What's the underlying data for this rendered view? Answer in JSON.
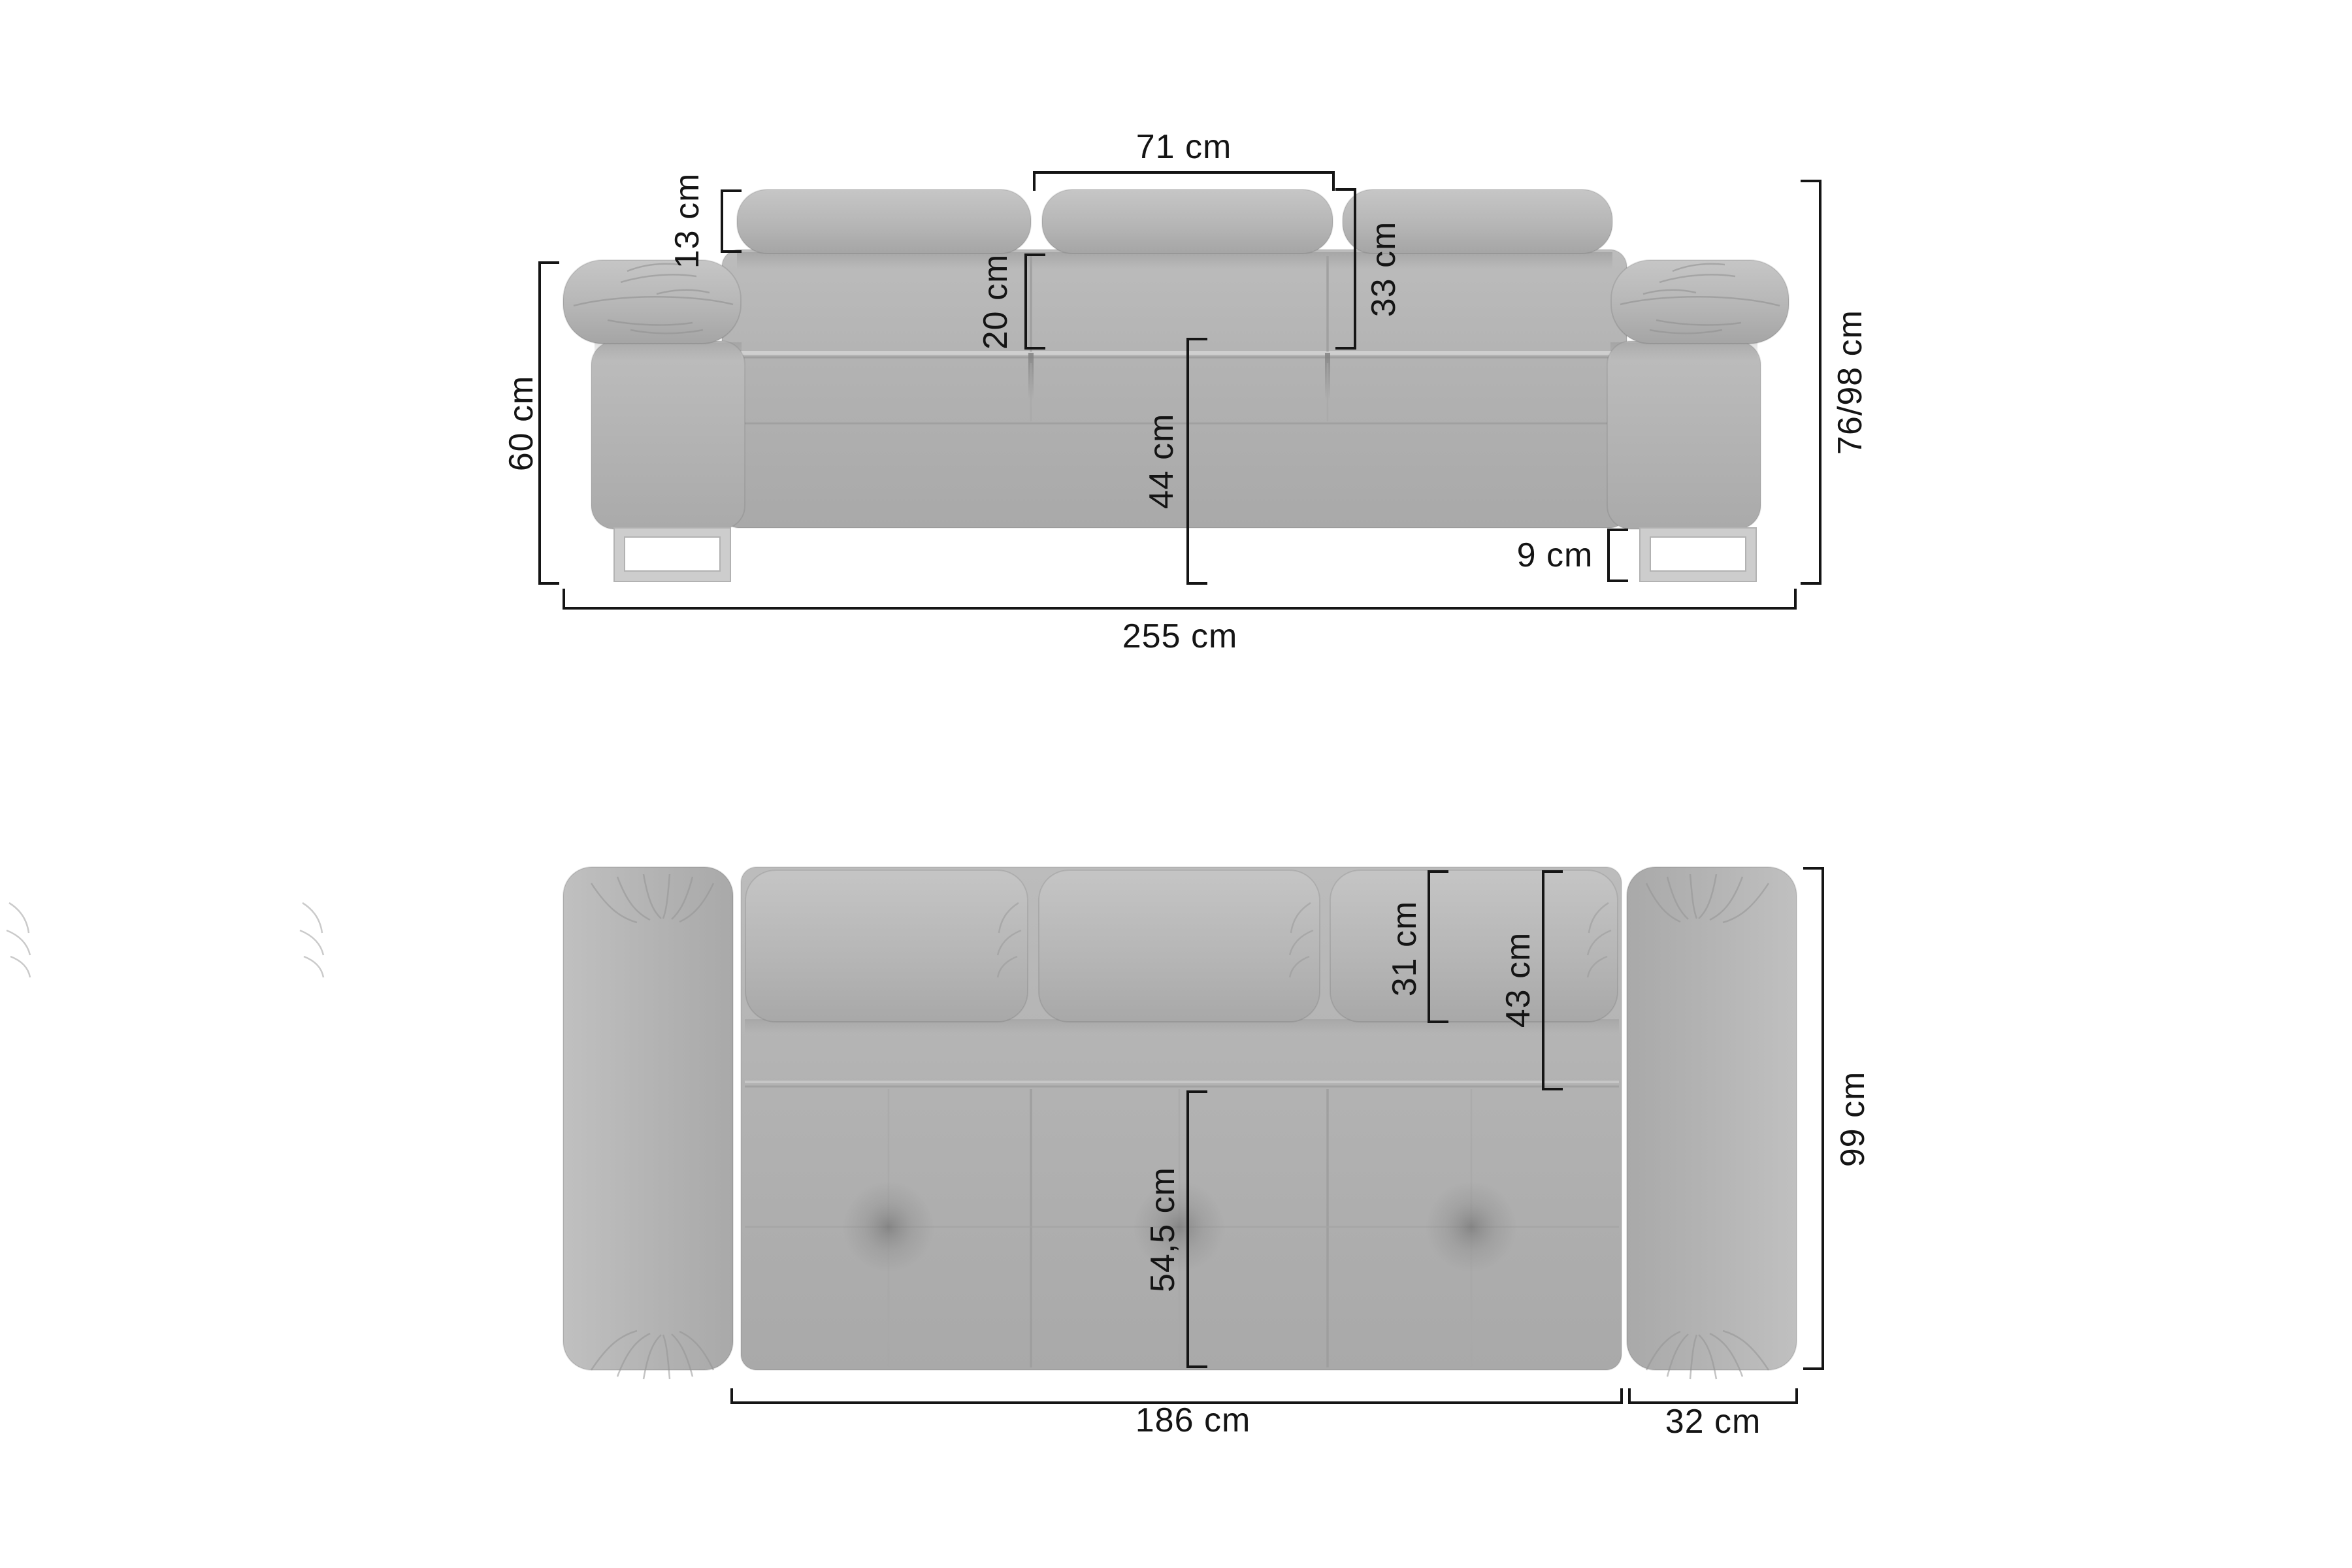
{
  "unit": "cm",
  "colors": {
    "background": "#ffffff",
    "dimension_line": "#151515",
    "sofa_base": "#b3b3b3",
    "sofa_highlight": "#c6c6c6",
    "sofa_shadow": "#a0a0a0",
    "leg": "#cdcdcd"
  },
  "front_view": {
    "headrest_width": {
      "label": "71 cm"
    },
    "headrest_height": {
      "label": "13 cm"
    },
    "backrest_upper_height": {
      "label": "20 cm"
    },
    "headrest_to_seat": {
      "label": "33 cm"
    },
    "armrest_height": {
      "label": "60 cm"
    },
    "total_height": {
      "label": "76/98 cm"
    },
    "seat_height": {
      "label": "44 cm"
    },
    "leg_height": {
      "label": "9 cm"
    },
    "total_width": {
      "label": "255 cm"
    }
  },
  "top_view": {
    "back_cushion_depth": {
      "label": "31 cm"
    },
    "backrest_depth": {
      "label": "43 cm"
    },
    "seat_depth": {
      "label": "54,5 cm"
    },
    "total_depth": {
      "label": "99 cm"
    },
    "seat_width": {
      "label": "186 cm"
    },
    "armrest_width": {
      "label": "32 cm"
    }
  }
}
